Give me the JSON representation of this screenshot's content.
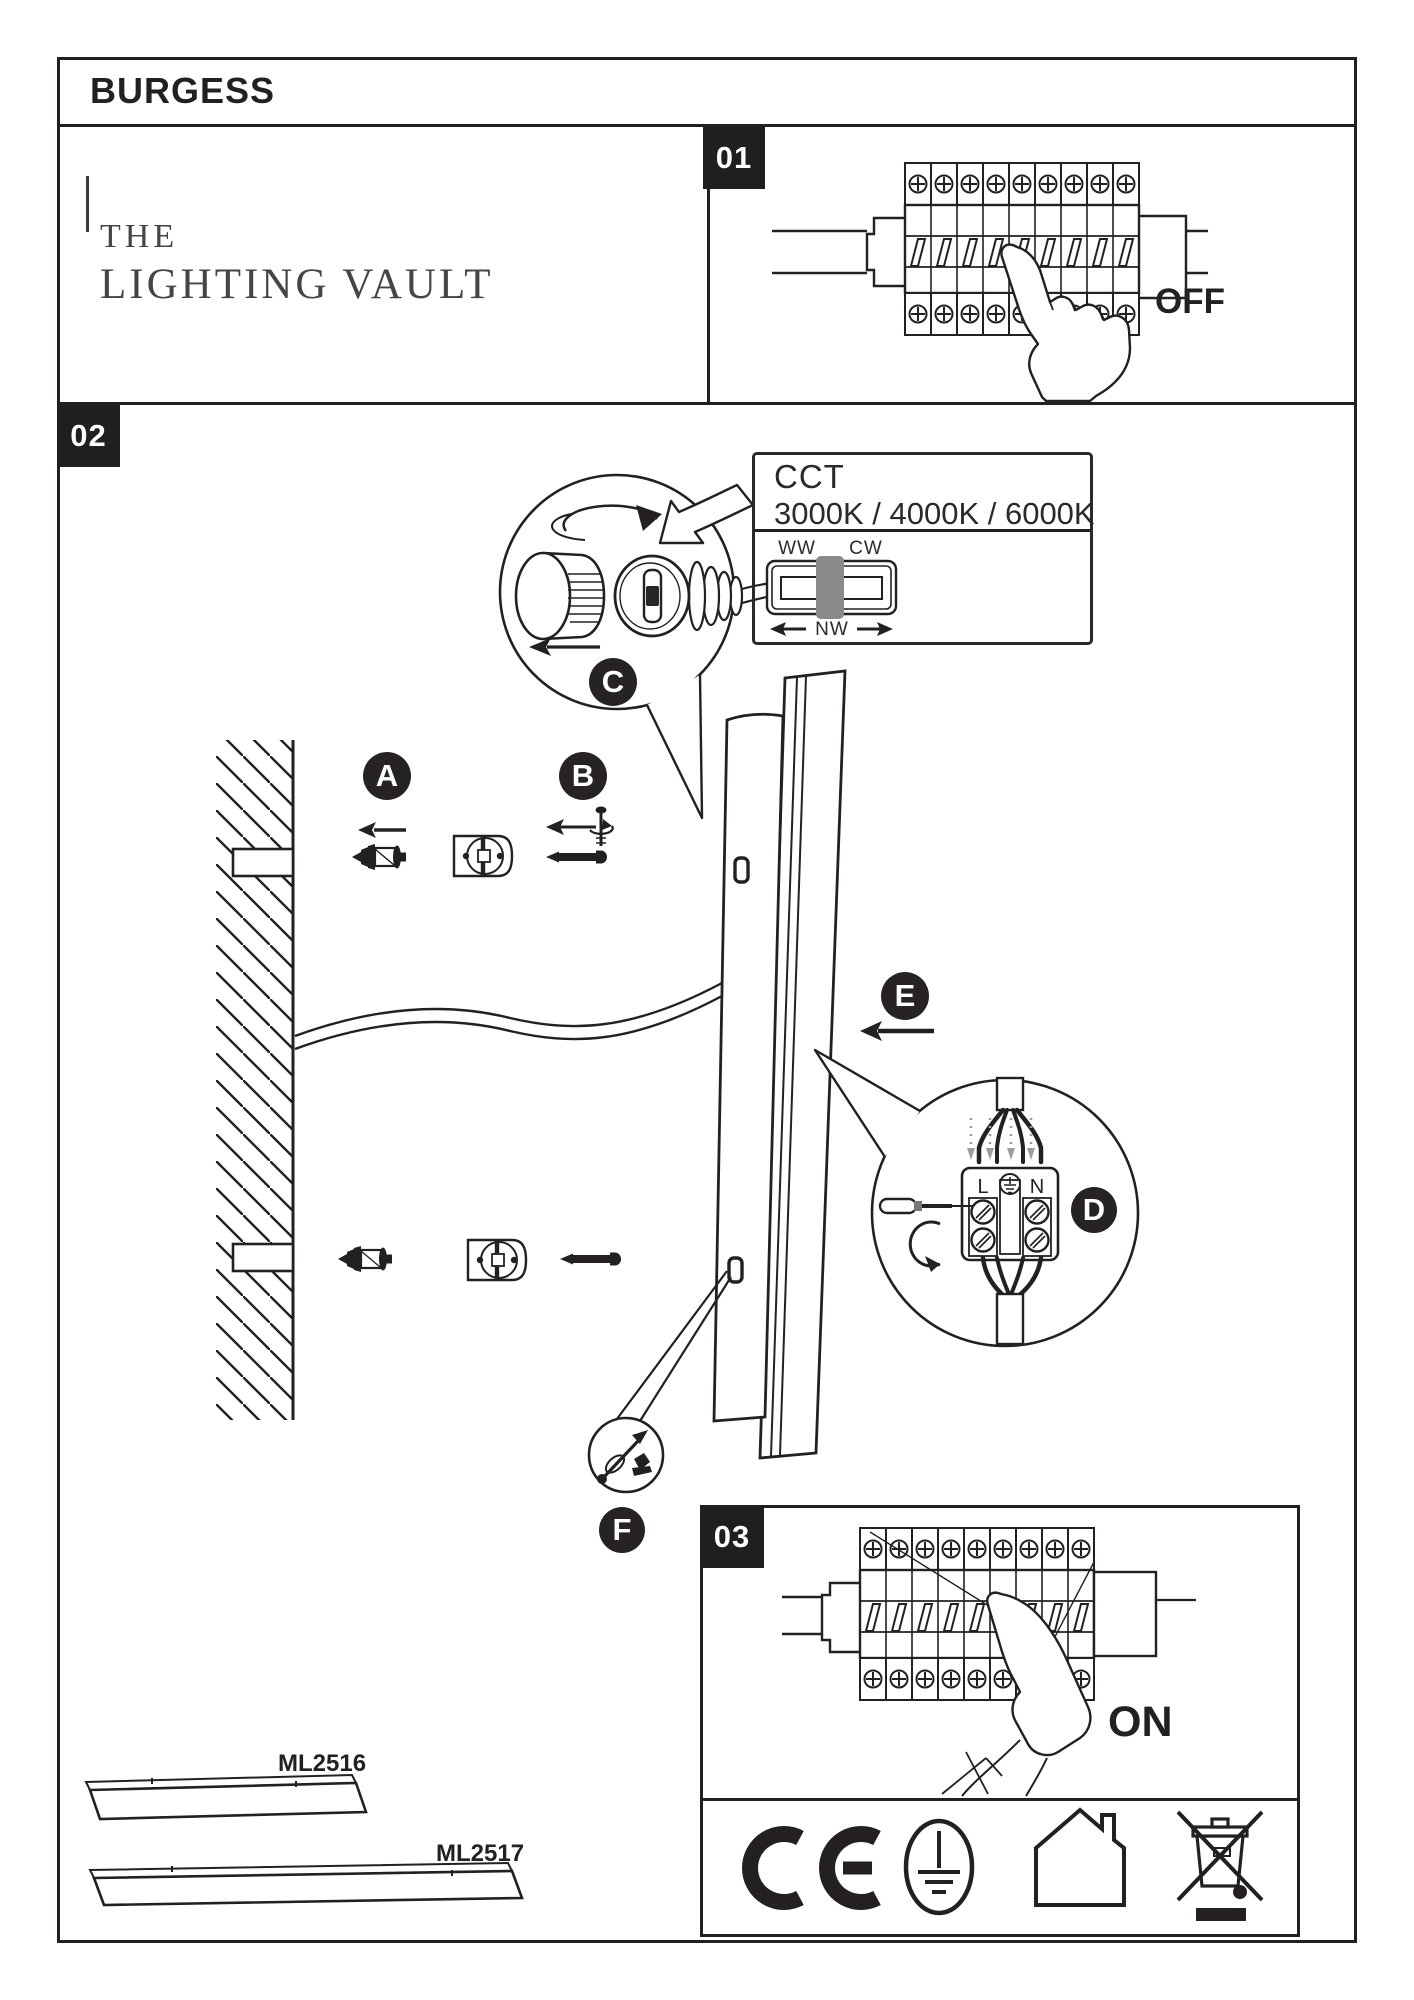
{
  "brand": "BURGESS",
  "logo": {
    "line1": "THE",
    "line2": "LIGHTING VAULT"
  },
  "steps": {
    "one": {
      "number": "01",
      "label": "OFF"
    },
    "two": {
      "number": "02"
    },
    "three": {
      "number": "03",
      "label": "ON"
    }
  },
  "cct": {
    "title": "CCT",
    "options": "3000K / 4000K / 6000K",
    "warm": "WW",
    "cool": "CW",
    "neutral": "NW"
  },
  "callouts": {
    "a": "A",
    "b": "B",
    "c": "C",
    "d": "D",
    "e": "E",
    "f": "F"
  },
  "terminal": {
    "live": "L",
    "neutral": "N"
  },
  "products": {
    "short_code": "ML2516",
    "long_code": "ML2517"
  },
  "colors": {
    "ink": "#242021",
    "badge": "#272324",
    "slider_gray": "#8a8a8a",
    "arrow_gray": "#9d9d9c"
  },
  "icons": {
    "certifications": [
      "ce-mark",
      "protective-earth",
      "indoor-use-only",
      "weee-separate-collection"
    ]
  }
}
